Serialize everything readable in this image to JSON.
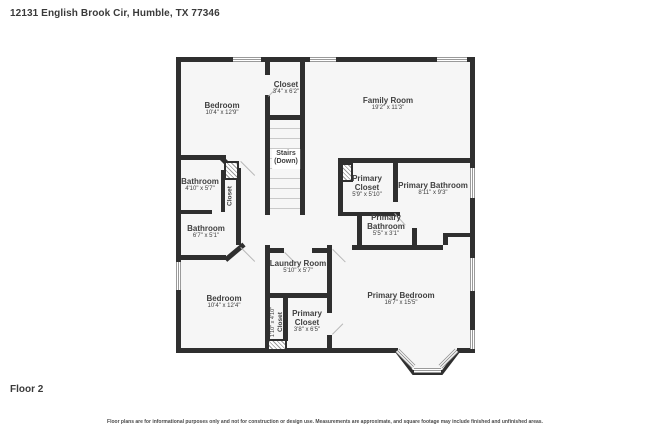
{
  "header": {
    "address": "12131 English Brook Cir, Humble, TX 77346"
  },
  "floor": {
    "label": "Floor 2"
  },
  "footer": {
    "disclaimer": "Floor plans are for informational purposes only and not for construction or design use. Measurements are approximate, and square footage may include finished and unfinished areas."
  },
  "colors": {
    "wall": "#2f2f2f",
    "room_fill": "#f6f6f6",
    "text": "#404040"
  },
  "rooms": [
    {
      "name": "Bedroom",
      "dims": "10'4\" x 12'9\""
    },
    {
      "name": "Closet",
      "dims": "3'4\" x 6'2\""
    },
    {
      "name": "Family Room",
      "dims": "19'2\" x 11'3\""
    },
    {
      "name": "Stairs",
      "dims": "(Down)"
    },
    {
      "name": "Bathroom",
      "dims": "4'10\" x 5'7\""
    },
    {
      "name": "Closet",
      "dims": ""
    },
    {
      "name": "Bathroom",
      "dims": "6'7\" x 5'1\""
    },
    {
      "name": "Primary Closet",
      "dims": "5'9\" x 5'10\""
    },
    {
      "name": "Primary Bathroom",
      "dims": "8'11\" x 9'3\""
    },
    {
      "name": "Primary Bathroom",
      "dims": "5'5\" x 3'1\""
    },
    {
      "name": "Laundry Room",
      "dims": "5'10\" x 5'7\""
    },
    {
      "name": "Bedroom",
      "dims": "10'4\" x 12'4\""
    },
    {
      "name": "Closet",
      "dims": "1'10\" x 4'10\""
    },
    {
      "name": "Primary Closet",
      "dims": "3'8\" x 6'5\""
    },
    {
      "name": "Primary Bedroom",
      "dims": "16'7\" x 15'5\""
    }
  ]
}
